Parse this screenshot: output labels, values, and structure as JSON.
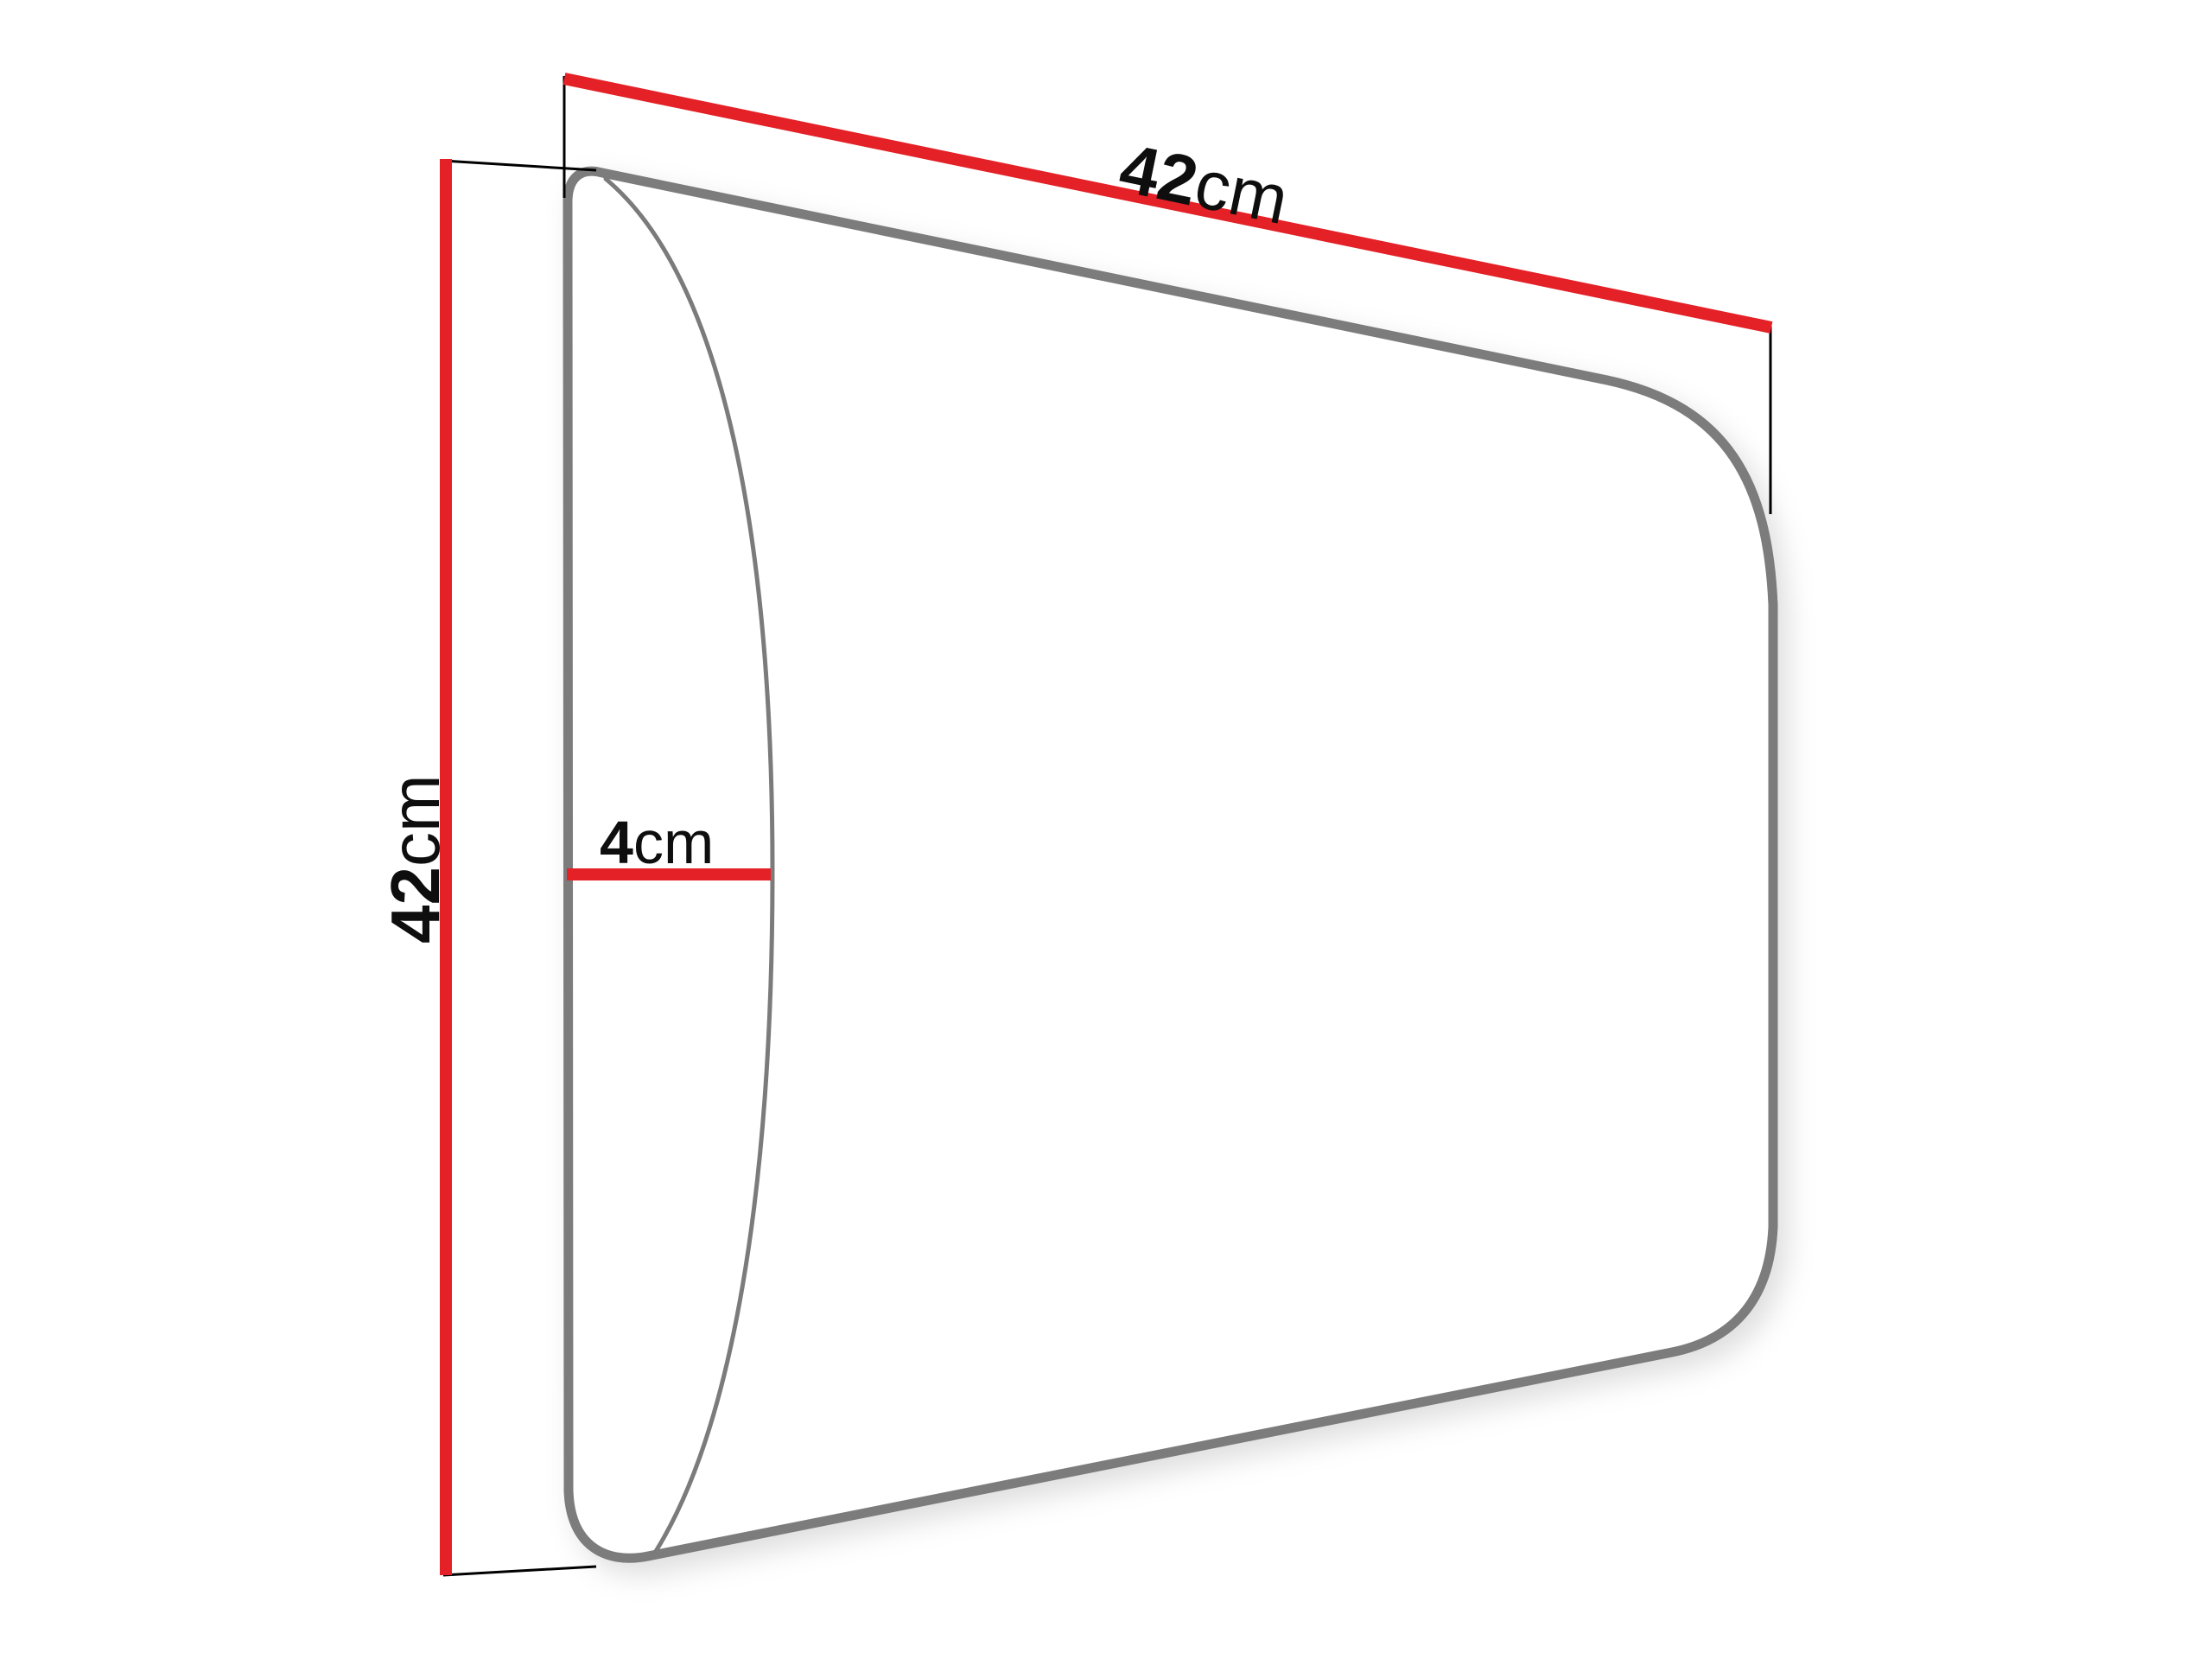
{
  "diagram": {
    "type": "product-dimension-drawing",
    "subject": "upholstered wall panel, perspective side view",
    "labels": {
      "width": {
        "value": "42",
        "unit": "cm"
      },
      "height": {
        "value": "42",
        "unit": "cm"
      },
      "depth": {
        "value": "4",
        "unit": "cm"
      }
    },
    "colors": {
      "dimension_line": "#e32127",
      "panel_outline": "#7b7b7b",
      "extension_line": "#000000",
      "text": "#0e0e0e",
      "background": "#ffffff"
    }
  }
}
